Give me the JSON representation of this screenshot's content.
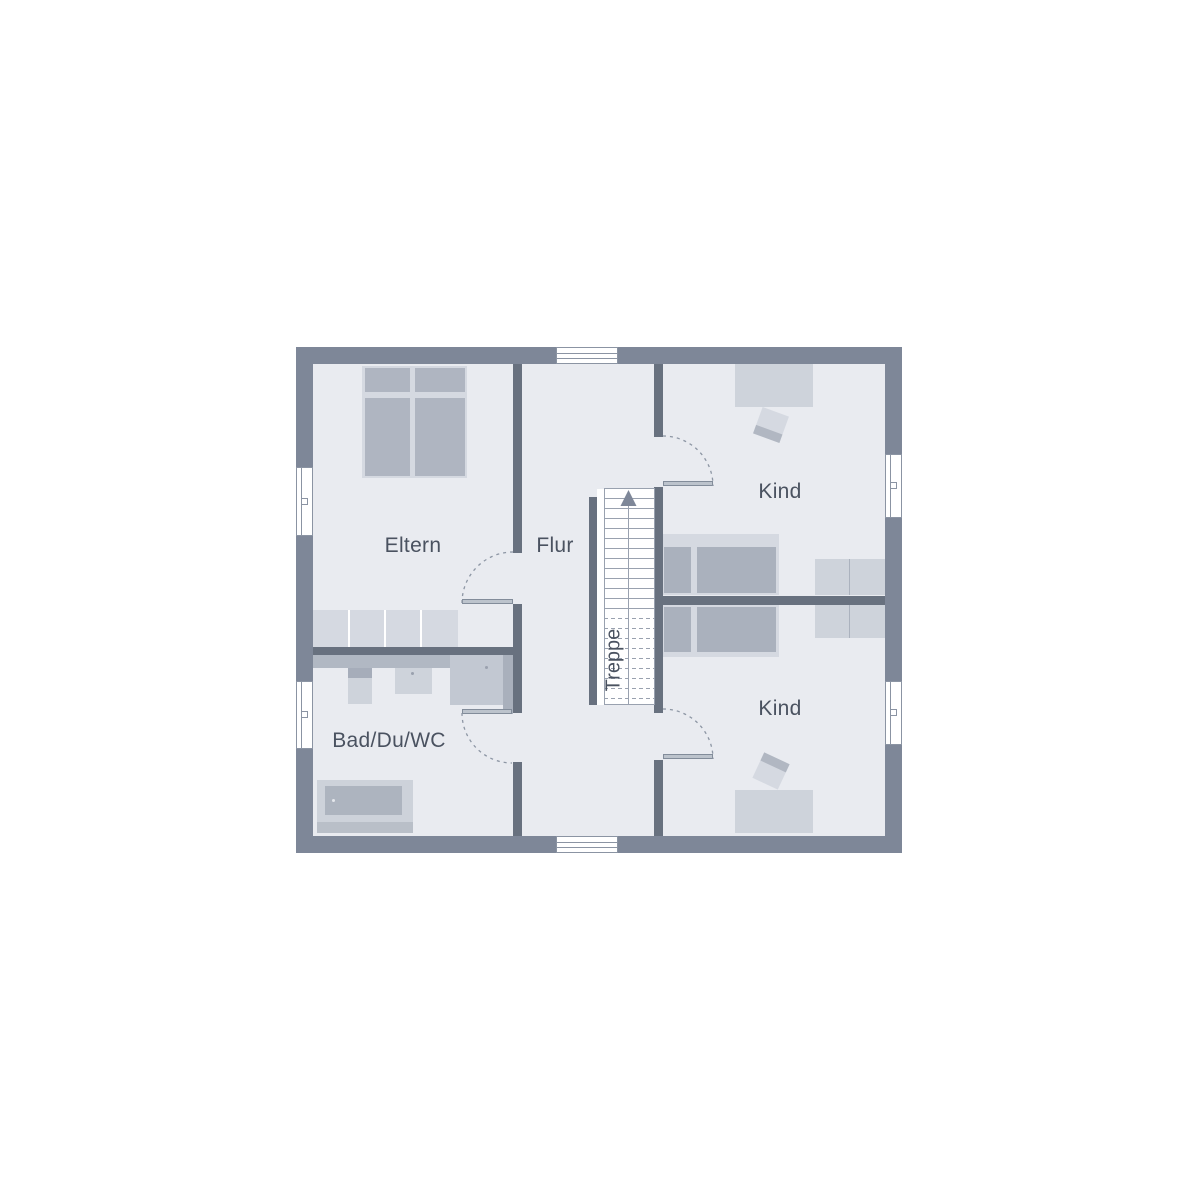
{
  "plan": {
    "title": "floor-plan-upper-storey",
    "rooms": {
      "parents": {
        "label": "Eltern"
      },
      "hall": {
        "label": "Flur"
      },
      "child_top": {
        "label": "Kind"
      },
      "child_bottom": {
        "label": "Kind"
      },
      "bath": {
        "label": "Bad/Du/WC"
      }
    },
    "stairs": {
      "label": "Treppe",
      "direction": "up"
    },
    "colors": {
      "wall_outer": "#7E8798",
      "wall_inner": "#68717F",
      "floor": "#E9EBF0",
      "furniture_light": "#D5D9E1",
      "furniture_mid": "#CED3DB",
      "furniture_dark": "#AFB5C1",
      "counter": "#B1B8C3",
      "stair_line": "#99A1AF",
      "door_arc": "#8D96A4",
      "window_frame": "#8B94A3",
      "label_text": "#4A5260"
    }
  }
}
